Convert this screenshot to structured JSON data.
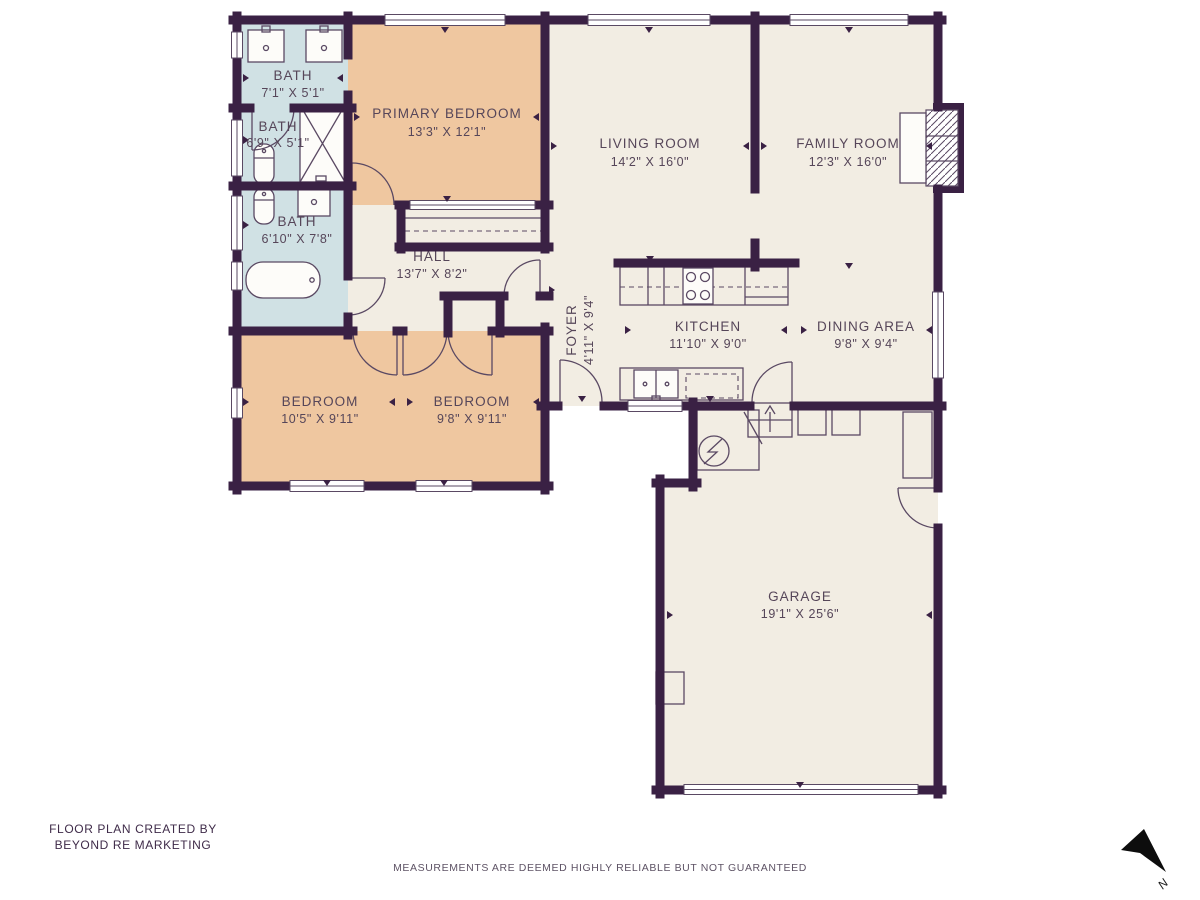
{
  "colors": {
    "wall": "#3a2144",
    "floor": "#f2ede3",
    "bedroom": "#efc7a0",
    "bath": "#d0e1e4",
    "line": "#5a4963",
    "text": "#564659",
    "footer": "#3f2b49",
    "disclaimer": "#5e5365"
  },
  "rooms": {
    "bath_top": {
      "name": "BATH",
      "dims": "7'1\" X 5'1\""
    },
    "bath_mid": {
      "name": "BATH",
      "dims": "6'9\" X 5'1\""
    },
    "bath_lower": {
      "name": "BATH",
      "dims": "6'10\" X 7'8\""
    },
    "primary_bedroom": {
      "name": "PRIMARY BEDROOM",
      "dims": "13'3\" X 12'1\""
    },
    "living_room": {
      "name": "LIVING ROOM",
      "dims": "14'2\" X 16'0\""
    },
    "family_room": {
      "name": "FAMILY ROOM",
      "dims": "12'3\" X 16'0\""
    },
    "hall": {
      "name": "HALL",
      "dims": "13'7\" X 8'2\""
    },
    "foyer": {
      "name": "FOYER",
      "dims": "4'11\" X 9'4\""
    },
    "kitchen": {
      "name": "KITCHEN",
      "dims": "11'10\" X 9'0\""
    },
    "dining_area": {
      "name": "DINING AREA",
      "dims": "9'8\" X 9'4\""
    },
    "bedroom_left": {
      "name": "BEDROOM",
      "dims": "10'5\" X 9'11\""
    },
    "bedroom_right": {
      "name": "BEDROOM",
      "dims": "9'8\" X 9'11\""
    },
    "garage": {
      "name": "GARAGE",
      "dims": "19'1\" X 25'6\""
    }
  },
  "footer": {
    "credit_line1": "FLOOR PLAN CREATED BY",
    "credit_line2": "BEYOND RE MARKETING",
    "disclaimer": "MEASUREMENTS ARE DEEMED HIGHLY RELIABLE BUT NOT GUARANTEED"
  },
  "compass": {
    "north_label": "N"
  }
}
